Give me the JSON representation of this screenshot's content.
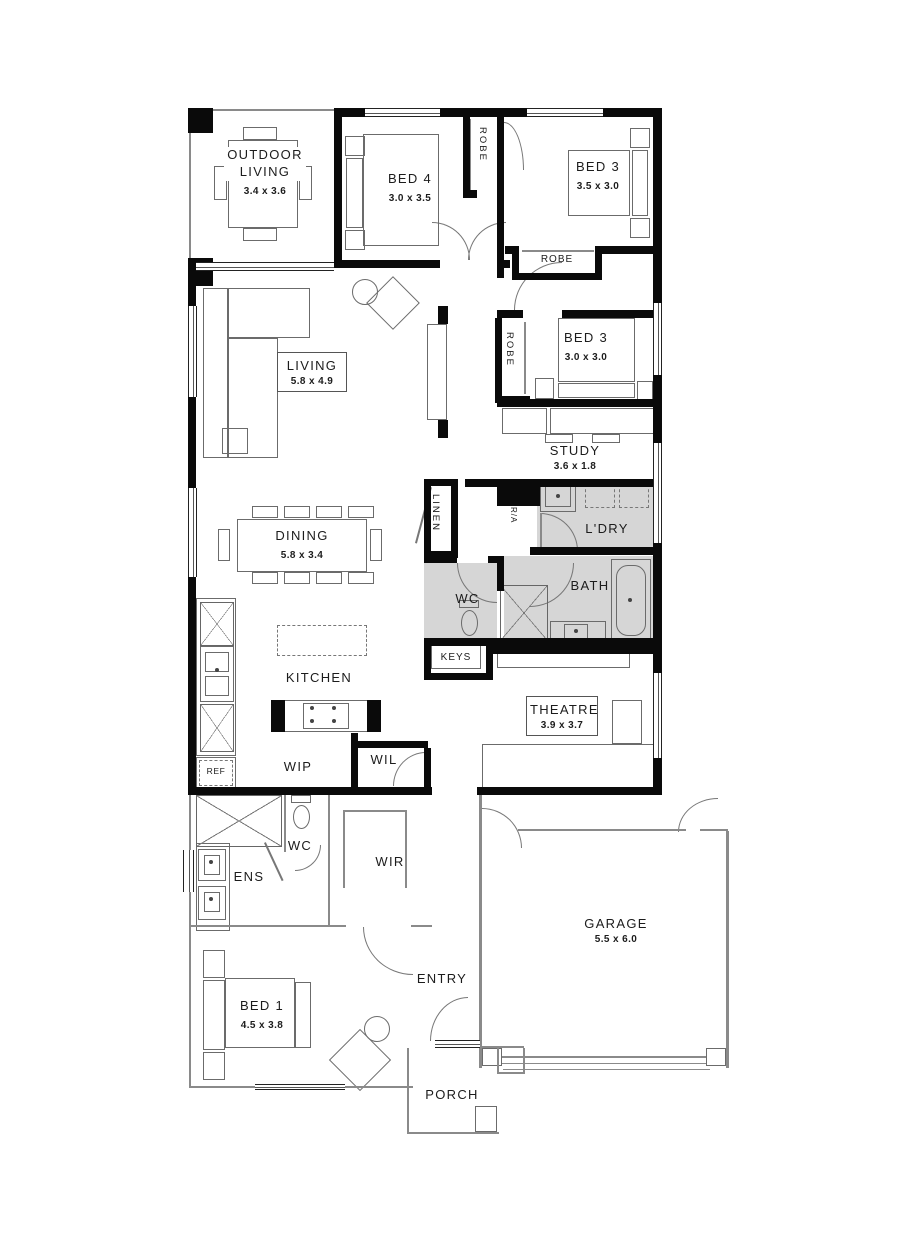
{
  "plan_title": "house-floor-plan",
  "colors": {
    "wall": "#0a0a0a",
    "wet_area_floor": "#d6d6d6",
    "background": "#ffffff"
  },
  "rooms": {
    "outdoor_living": {
      "name": "OUTDOOR\nLIVING",
      "size": "3.4 x 3.6"
    },
    "bed4": {
      "name": "BED 4",
      "size": "3.0 x 3.5"
    },
    "bed3a": {
      "name": "BED 3",
      "size": "3.5 x 3.0"
    },
    "bed3b": {
      "name": "BED 3",
      "size": "3.0 x 3.0"
    },
    "study": {
      "name": "STUDY",
      "size": "3.6 x 1.8"
    },
    "ldry": {
      "name": "L'DRY"
    },
    "wc_main": {
      "name": "WC"
    },
    "bath": {
      "name": "BATH"
    },
    "keys": {
      "name": "KEYS"
    },
    "living": {
      "name": "LIVING",
      "size": "5.8 x 4.9"
    },
    "dining": {
      "name": "DINING",
      "size": "5.8 x 3.4"
    },
    "kitchen": {
      "name": "KITCHEN"
    },
    "wip": {
      "name": "WIP"
    },
    "wil": {
      "name": "WIL"
    },
    "ref": {
      "name": "REF"
    },
    "theatre": {
      "name": "THEATRE",
      "size": "3.9 x 3.7"
    },
    "ens": {
      "name": "ENS"
    },
    "wc_ens": {
      "name": "WC"
    },
    "wir": {
      "name": "WIR"
    },
    "bed1": {
      "name": "BED 1",
      "size": "4.5 x 3.8"
    },
    "entry": {
      "name": "ENTRY"
    },
    "garage": {
      "name": "GARAGE",
      "size": "5.5 x 6.0"
    },
    "porch": {
      "name": "PORCH"
    },
    "robe_top": {
      "name": "ROBE"
    },
    "robe_bed3a": {
      "name": "ROBE"
    },
    "robe_bed3b": {
      "name": "ROBE"
    },
    "linen": {
      "name": "LINEN"
    },
    "return_air": {
      "name": "R/A"
    }
  }
}
